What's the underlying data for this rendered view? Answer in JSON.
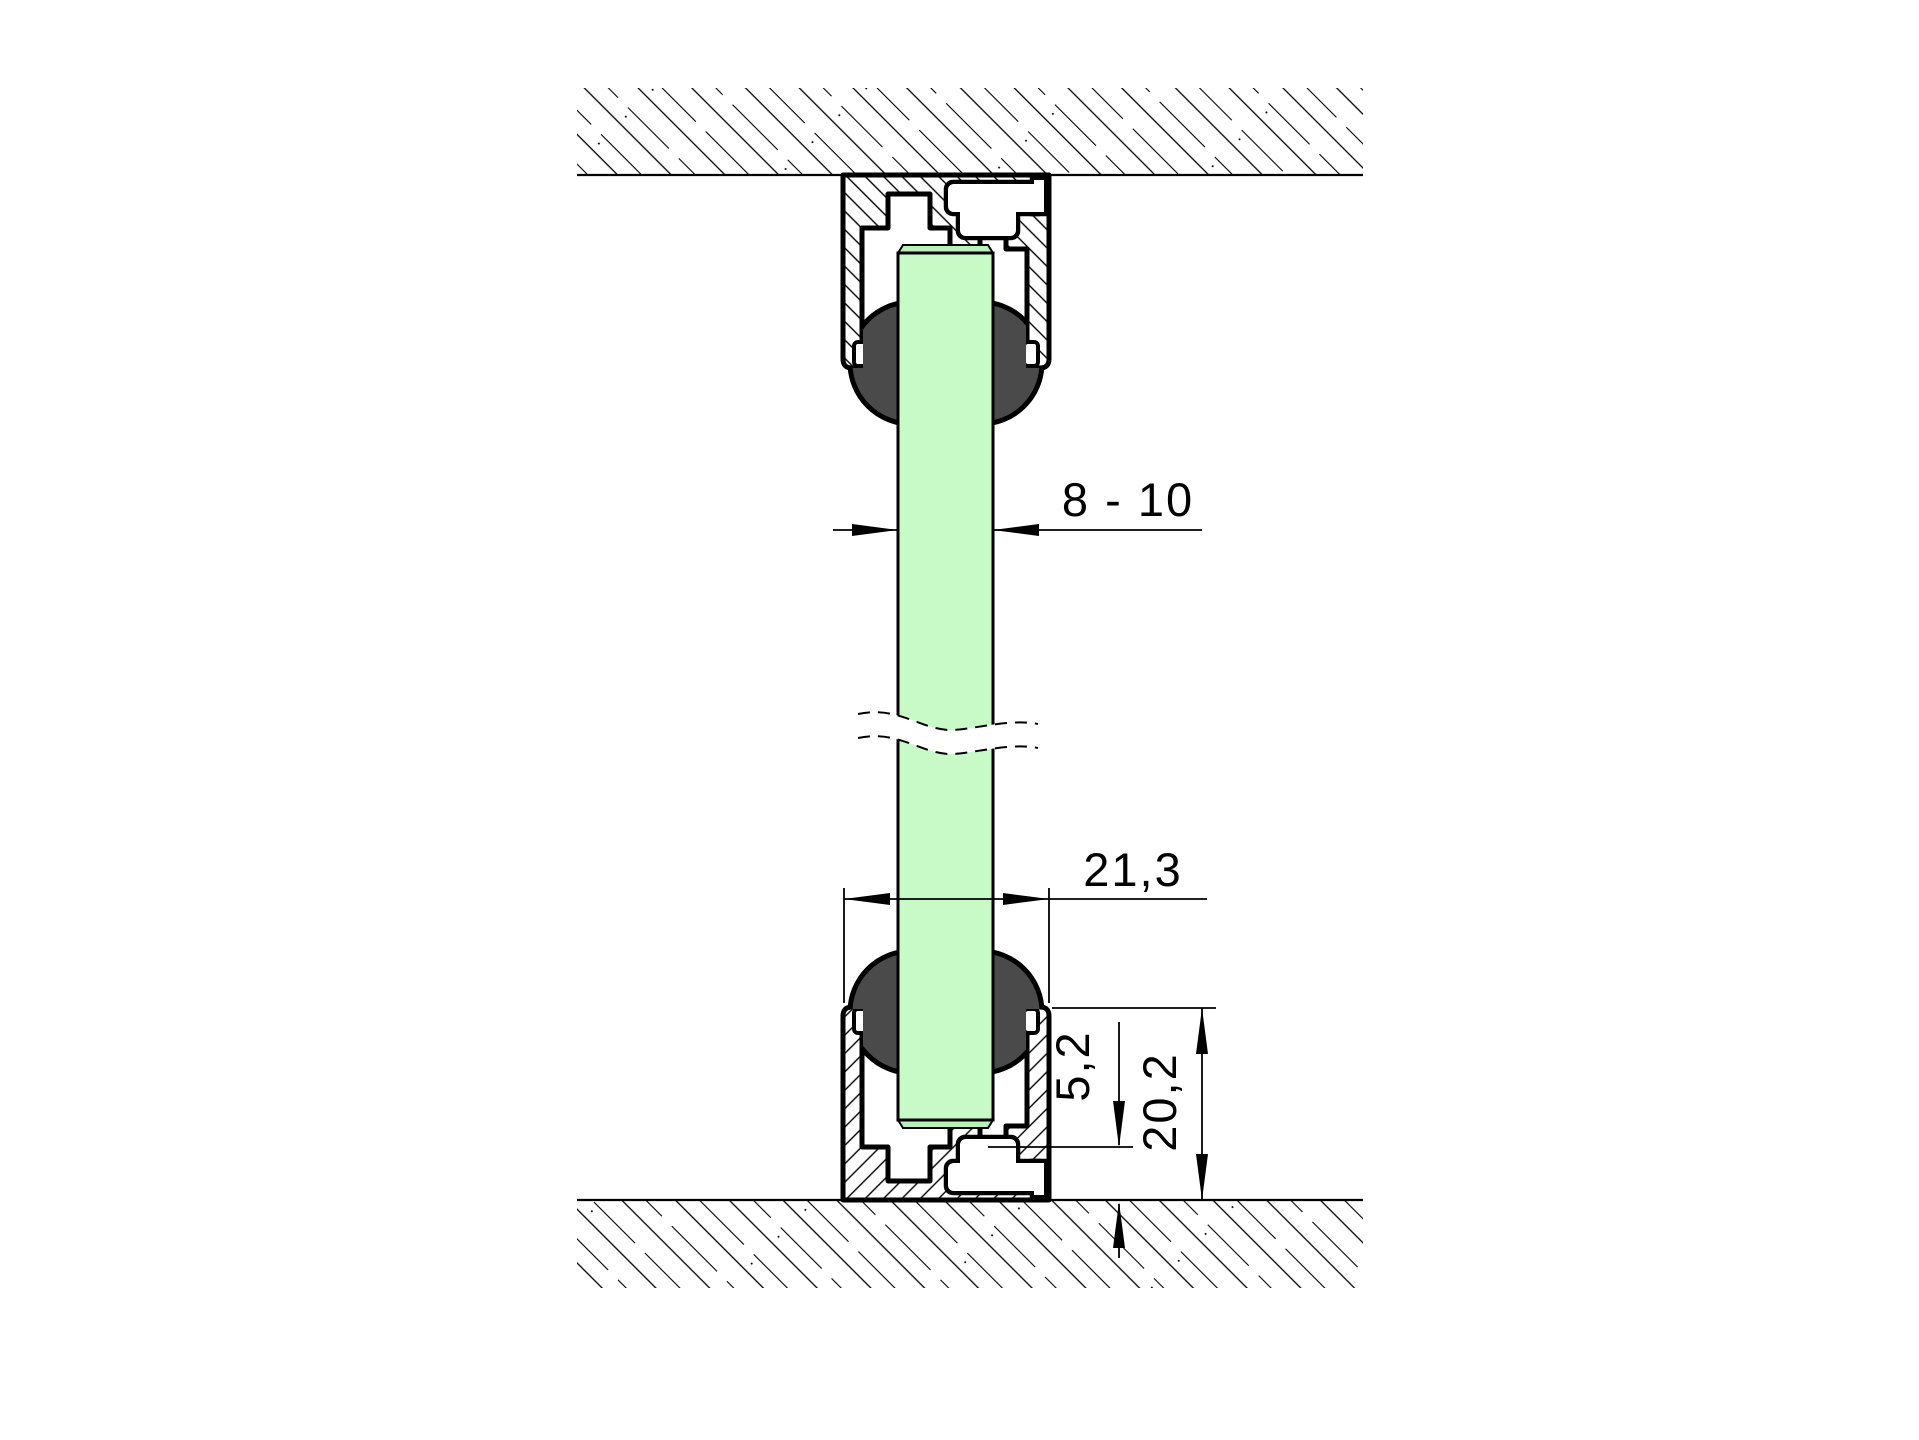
{
  "drawing": {
    "type": "technical-cross-section",
    "description": "Glass panel clamped between ceiling and floor U-channel profiles with round gasket seals",
    "dimensions": {
      "glass_thickness_mm": "8 - 10",
      "channel_width_mm": "21,3",
      "base_thickness_mm": "5,2",
      "channel_height_mm": "20,2"
    },
    "colors": {
      "glass_fill": "#c7fac7",
      "glass_edge_fill": "#b9efb9",
      "gasket_fill": "#4a4a4a",
      "outline": "#000000",
      "background": "#ffffff"
    }
  }
}
